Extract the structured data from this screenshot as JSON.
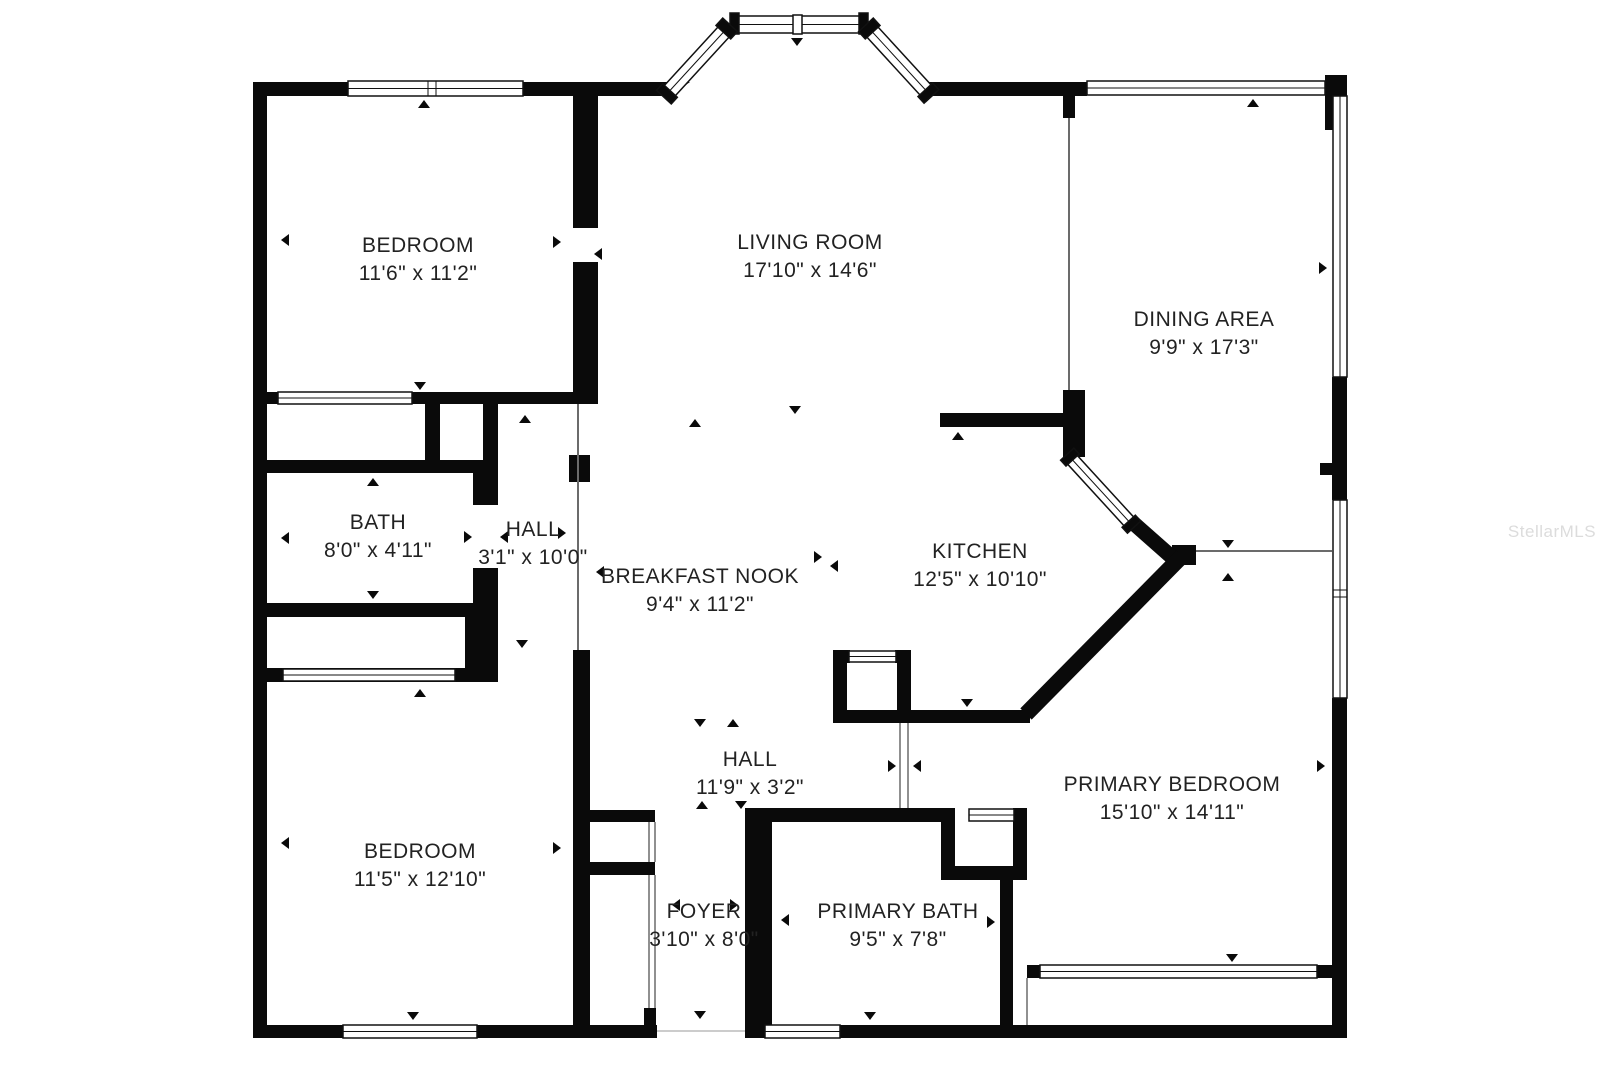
{
  "watermark": {
    "text": "StellarMLS",
    "color": "#dcdcdc"
  },
  "colors": {
    "wall": "#0a0a0a",
    "background": "#ffffff",
    "label_text": "#222222",
    "thin_partition": "#6b6b6b"
  },
  "rooms": [
    {
      "id": "bedroom-1",
      "name": "BEDROOM",
      "dims": "11'6\" x 11'2\""
    },
    {
      "id": "living-room",
      "name": "LIVING ROOM",
      "dims": "17'10\" x 14'6\""
    },
    {
      "id": "dining-area",
      "name": "DINING AREA",
      "dims": "9'9\" x 17'3\""
    },
    {
      "id": "bath",
      "name": "BATH",
      "dims": "8'0\" x 4'11\""
    },
    {
      "id": "hall-1",
      "name": "HALL",
      "dims": "3'1\" x 10'0\""
    },
    {
      "id": "breakfast-nook",
      "name": "BREAKFAST NOOK",
      "dims": "9'4\" x 11'2\""
    },
    {
      "id": "kitchen",
      "name": "KITCHEN",
      "dims": "12'5\" x 10'10\""
    },
    {
      "id": "hall-2",
      "name": "HALL",
      "dims": "11'9\" x 3'2\""
    },
    {
      "id": "bedroom-2",
      "name": "BEDROOM",
      "dims": "11'5\" x 12'10\""
    },
    {
      "id": "foyer",
      "name": "FOYER",
      "dims": "3'10\" x 8'0\""
    },
    {
      "id": "primary-bath",
      "name": "PRIMARY BATH",
      "dims": "9'5\" x 7'8\""
    },
    {
      "id": "primary-bedroom",
      "name": "PRIMARY BEDROOM",
      "dims": "15'10\" x 14'11\""
    }
  ]
}
